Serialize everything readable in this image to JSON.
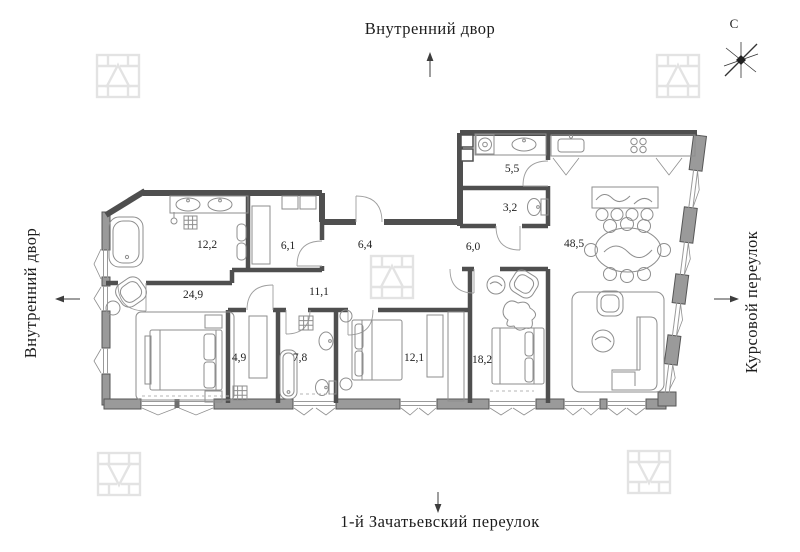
{
  "streets": {
    "top": "Внутренний двор",
    "left": "Внутренний двор",
    "right": "Курсовой переулок",
    "bottom": "1-й Зачатьевский переулок"
  },
  "compass": {
    "north": "С"
  },
  "rooms": {
    "bathroom_main": {
      "area": "12,2"
    },
    "dressing": {
      "area": "6,1"
    },
    "hallway": {
      "area": "6,4"
    },
    "hall": {
      "area": "6,0"
    },
    "laundry": {
      "area": "5,5"
    },
    "wc": {
      "area": "3,2"
    },
    "kitchen_living": {
      "area": "48,5"
    },
    "master_bedroom": {
      "area": "24,9"
    },
    "corridor": {
      "area": "11,1"
    },
    "closet": {
      "area": "4,9"
    },
    "bathroom_2": {
      "area": "7,8"
    },
    "bedroom_2": {
      "area": "12,1"
    },
    "bedroom_3": {
      "area": "18,2"
    }
  },
  "colors": {
    "wall": "#4f4f4f",
    "pier": "#9a9a9a",
    "furniture": "#8e8e8e",
    "watermark": "#e3e3e3",
    "text": "#1c1c1c"
  }
}
